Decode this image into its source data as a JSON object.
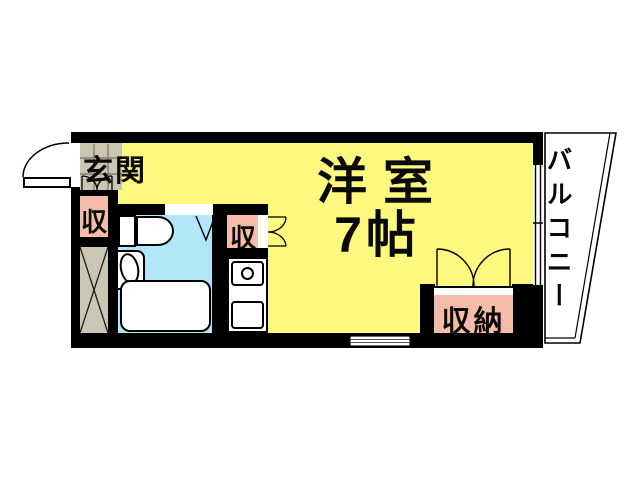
{
  "floorplan": {
    "labels": {
      "entrance": "玄関",
      "main_room_name": "洋室",
      "main_room_size": "7帖",
      "storage_entrance": "収",
      "storage_kitchen": "収",
      "closet": "収納",
      "balcony": "バルコニー"
    },
    "colors": {
      "room_yellow": "#FDF87E",
      "bathroom_cyan": "#B2E6F8",
      "storage_salmon": "#F5BDA9",
      "tile_gray": "#CBC5B4",
      "wall_black": "#000000"
    },
    "fixture_icons": [
      "entrance-door-swing-icon",
      "shoe-storage-doors-icon",
      "toilet-icon",
      "washbasin-icon",
      "bathtub-icon",
      "folding-door-icon",
      "stove-burner-icon",
      "kitchen-sink-icon",
      "closet-double-doors-icon",
      "balcony-window-icon",
      "bottom-wall-window-icon",
      "pipe-shaft-cross-icon"
    ]
  }
}
